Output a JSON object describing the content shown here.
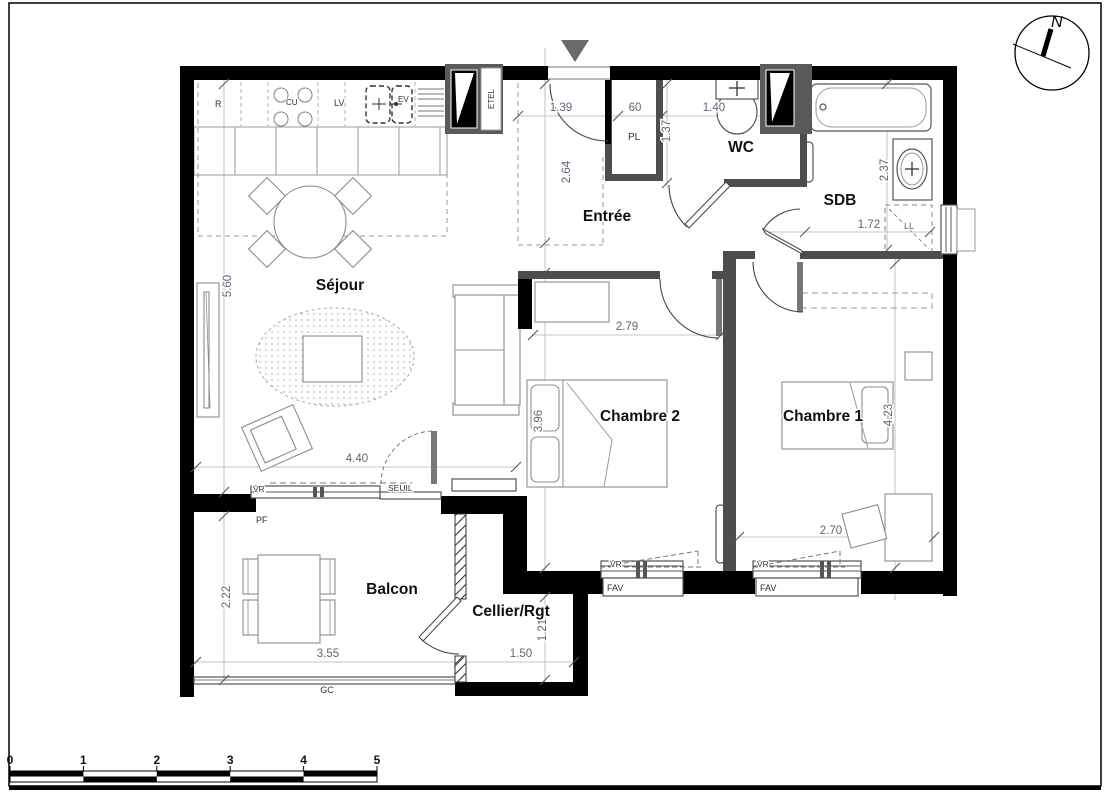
{
  "rooms": {
    "sejour": "Séjour",
    "entree": "Entrée",
    "wc": "WC",
    "sdb": "SDB",
    "chambre2": "Chambre 2",
    "chambre1": "Chambre 1",
    "balcon": "Balcon",
    "cellier": "Cellier/Rgt"
  },
  "equipment": {
    "fridge": "R",
    "hob": "CU",
    "dishwasher": "LV",
    "sink": "EV",
    "technical_closet": "ETEL",
    "entry_closet": "PL",
    "washing_machine": "LL"
  },
  "wall_annotations": {
    "shutter_sejour": "VR",
    "threshold": "SEUIL",
    "french_window": "PF",
    "guardrail": "GC",
    "shutter_ch2": "VR",
    "window_ch2": "FAV",
    "shutter_ch1": "VR",
    "window_ch1": "FAV"
  },
  "dimensions": {
    "entry_door_width": "1.39",
    "closet_width": "60",
    "wc_width": "1.40",
    "closet_depth": "1.37",
    "entree_depth": "2.64",
    "sdb_depth": "2.37",
    "sdb_width": "1.72",
    "sejour_depth": "5.60",
    "sejour_width": "4.40",
    "chambre2_width": "2.79",
    "chambre2_depth": "3.96",
    "chambre1_depth": "4.23",
    "chambre1_width": "2.70",
    "balcon_depth": "2.22",
    "balcon_width": "3.55",
    "cellier_width": "1.50",
    "cellier_depth": "1.21"
  },
  "compass": {
    "north": "N"
  },
  "scale_bar": {
    "ticks": [
      "0",
      "1",
      "2",
      "3",
      "4",
      "5"
    ]
  },
  "colors": {
    "wall": "#000000",
    "partition": "#4d4d4d",
    "furniture_line": "#8c8c8c",
    "dimension_text": "#5d6673",
    "room_label": "#111111",
    "entrance_arrow": "#6a6a6a",
    "background": "#ffffff"
  }
}
